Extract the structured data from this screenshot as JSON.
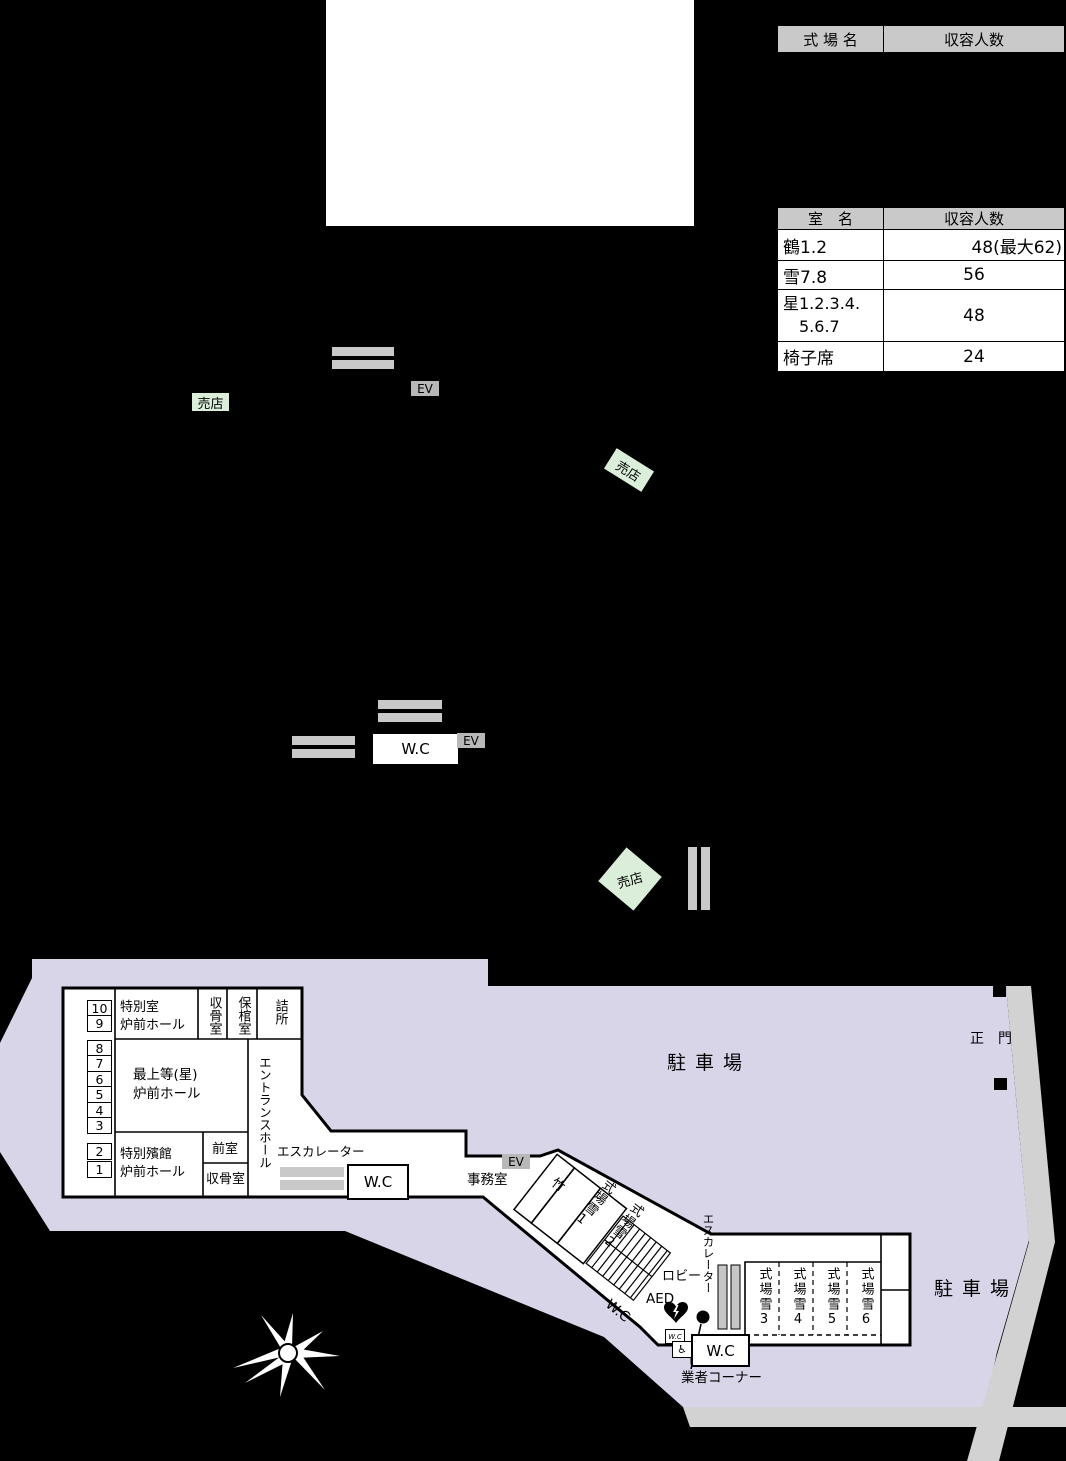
{
  "colors": {
    "parking": "#d8d5e8",
    "road": "#d2d2d2",
    "table_header_bg": "#c9c9c9",
    "shop_bg": "#daeeda",
    "ev_bg": "#b8b8b8",
    "bar_gray": "#c9c9c9"
  },
  "tables": {
    "venues": {
      "col_name": "式 場 名",
      "col_capacity": "収容人数"
    },
    "rooms": {
      "col_name": "室　名",
      "col_capacity": "収容人数",
      "rows": [
        {
          "name": "鶴1.2",
          "capacity": "48(最大62)"
        },
        {
          "name": "雪7.8",
          "capacity": "56"
        },
        {
          "name": "星1.2.3.4.",
          "name_line2": "5.6.7",
          "capacity": "48"
        },
        {
          "name": "椅子席",
          "capacity": "24"
        }
      ]
    }
  },
  "labels": {
    "shop": "売店",
    "ev": "EV",
    "wc": "W.C",
    "escalator": "エスカレーター",
    "parking": "駐車場",
    "main_gate": "正　門",
    "lobby": "ロビー",
    "aed": "AED",
    "vendor_corner": "業者コーナー",
    "wheelchair": "♿",
    "office": "事務室"
  },
  "floor": {
    "numbers": [
      "10",
      "9",
      "8",
      "7",
      "6",
      "5",
      "4",
      "3",
      "2",
      "1"
    ],
    "special_room_line1": "特別室",
    "special_room_line2": "炉前ホール",
    "shukotsu": "収骨室",
    "hokan": "保棺室",
    "tsumesho": "詰所",
    "entrance_hall": "エントランスホール",
    "saijoto_line1": "最上等(星)",
    "saijoto_line2": "炉前ホール",
    "hinkan_line1": "特別殯館",
    "hinkan_line2": "炉前ホール",
    "zenshitsu": "前室",
    "take": "竹",
    "yuki1": "式場雪1",
    "yuki2": "式場雪2",
    "yuki3": "式場雪3",
    "yuki4": "式場雪4",
    "yuki5": "式場雪5",
    "yuki6": "式場雪6"
  }
}
